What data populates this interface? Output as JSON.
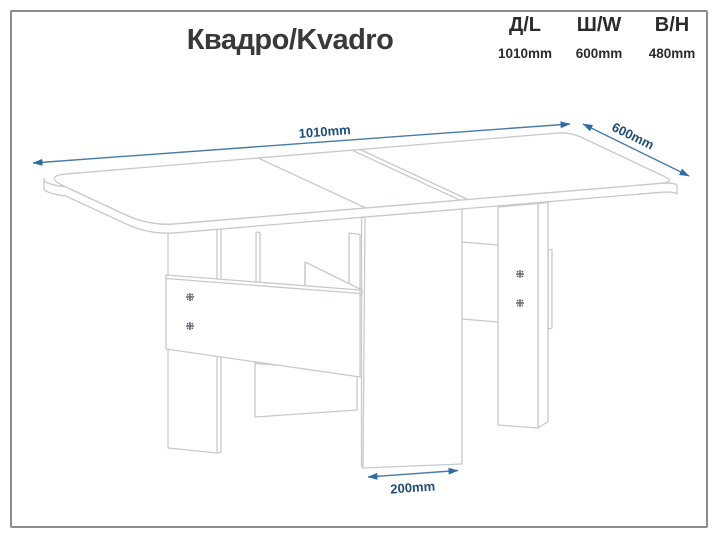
{
  "header": {
    "title": "Квадро/Kvadro",
    "spec_columns": [
      {
        "label": "Д/L",
        "value": "1010mm"
      },
      {
        "label": "Ш/W",
        "value": "600mm"
      },
      {
        "label": "В/H",
        "value": "480mm"
      }
    ]
  },
  "drawing": {
    "description": "Isometric line drawing of the Kvadro folding book-style table, shown unfolded on gate legs",
    "dimension_labels": {
      "length": "1010mm",
      "depth": "600mm",
      "base_width": "200mm"
    },
    "colors": {
      "outline": "#c6cacd",
      "dimension_line": "#477ca9",
      "dimension_text": "#1d4e77",
      "title_text": "#39393b",
      "spec_text": "#2b2b2d",
      "frame_border": "#8c8c8c",
      "screw": "#5f6468",
      "background": "#ffffff"
    }
  }
}
